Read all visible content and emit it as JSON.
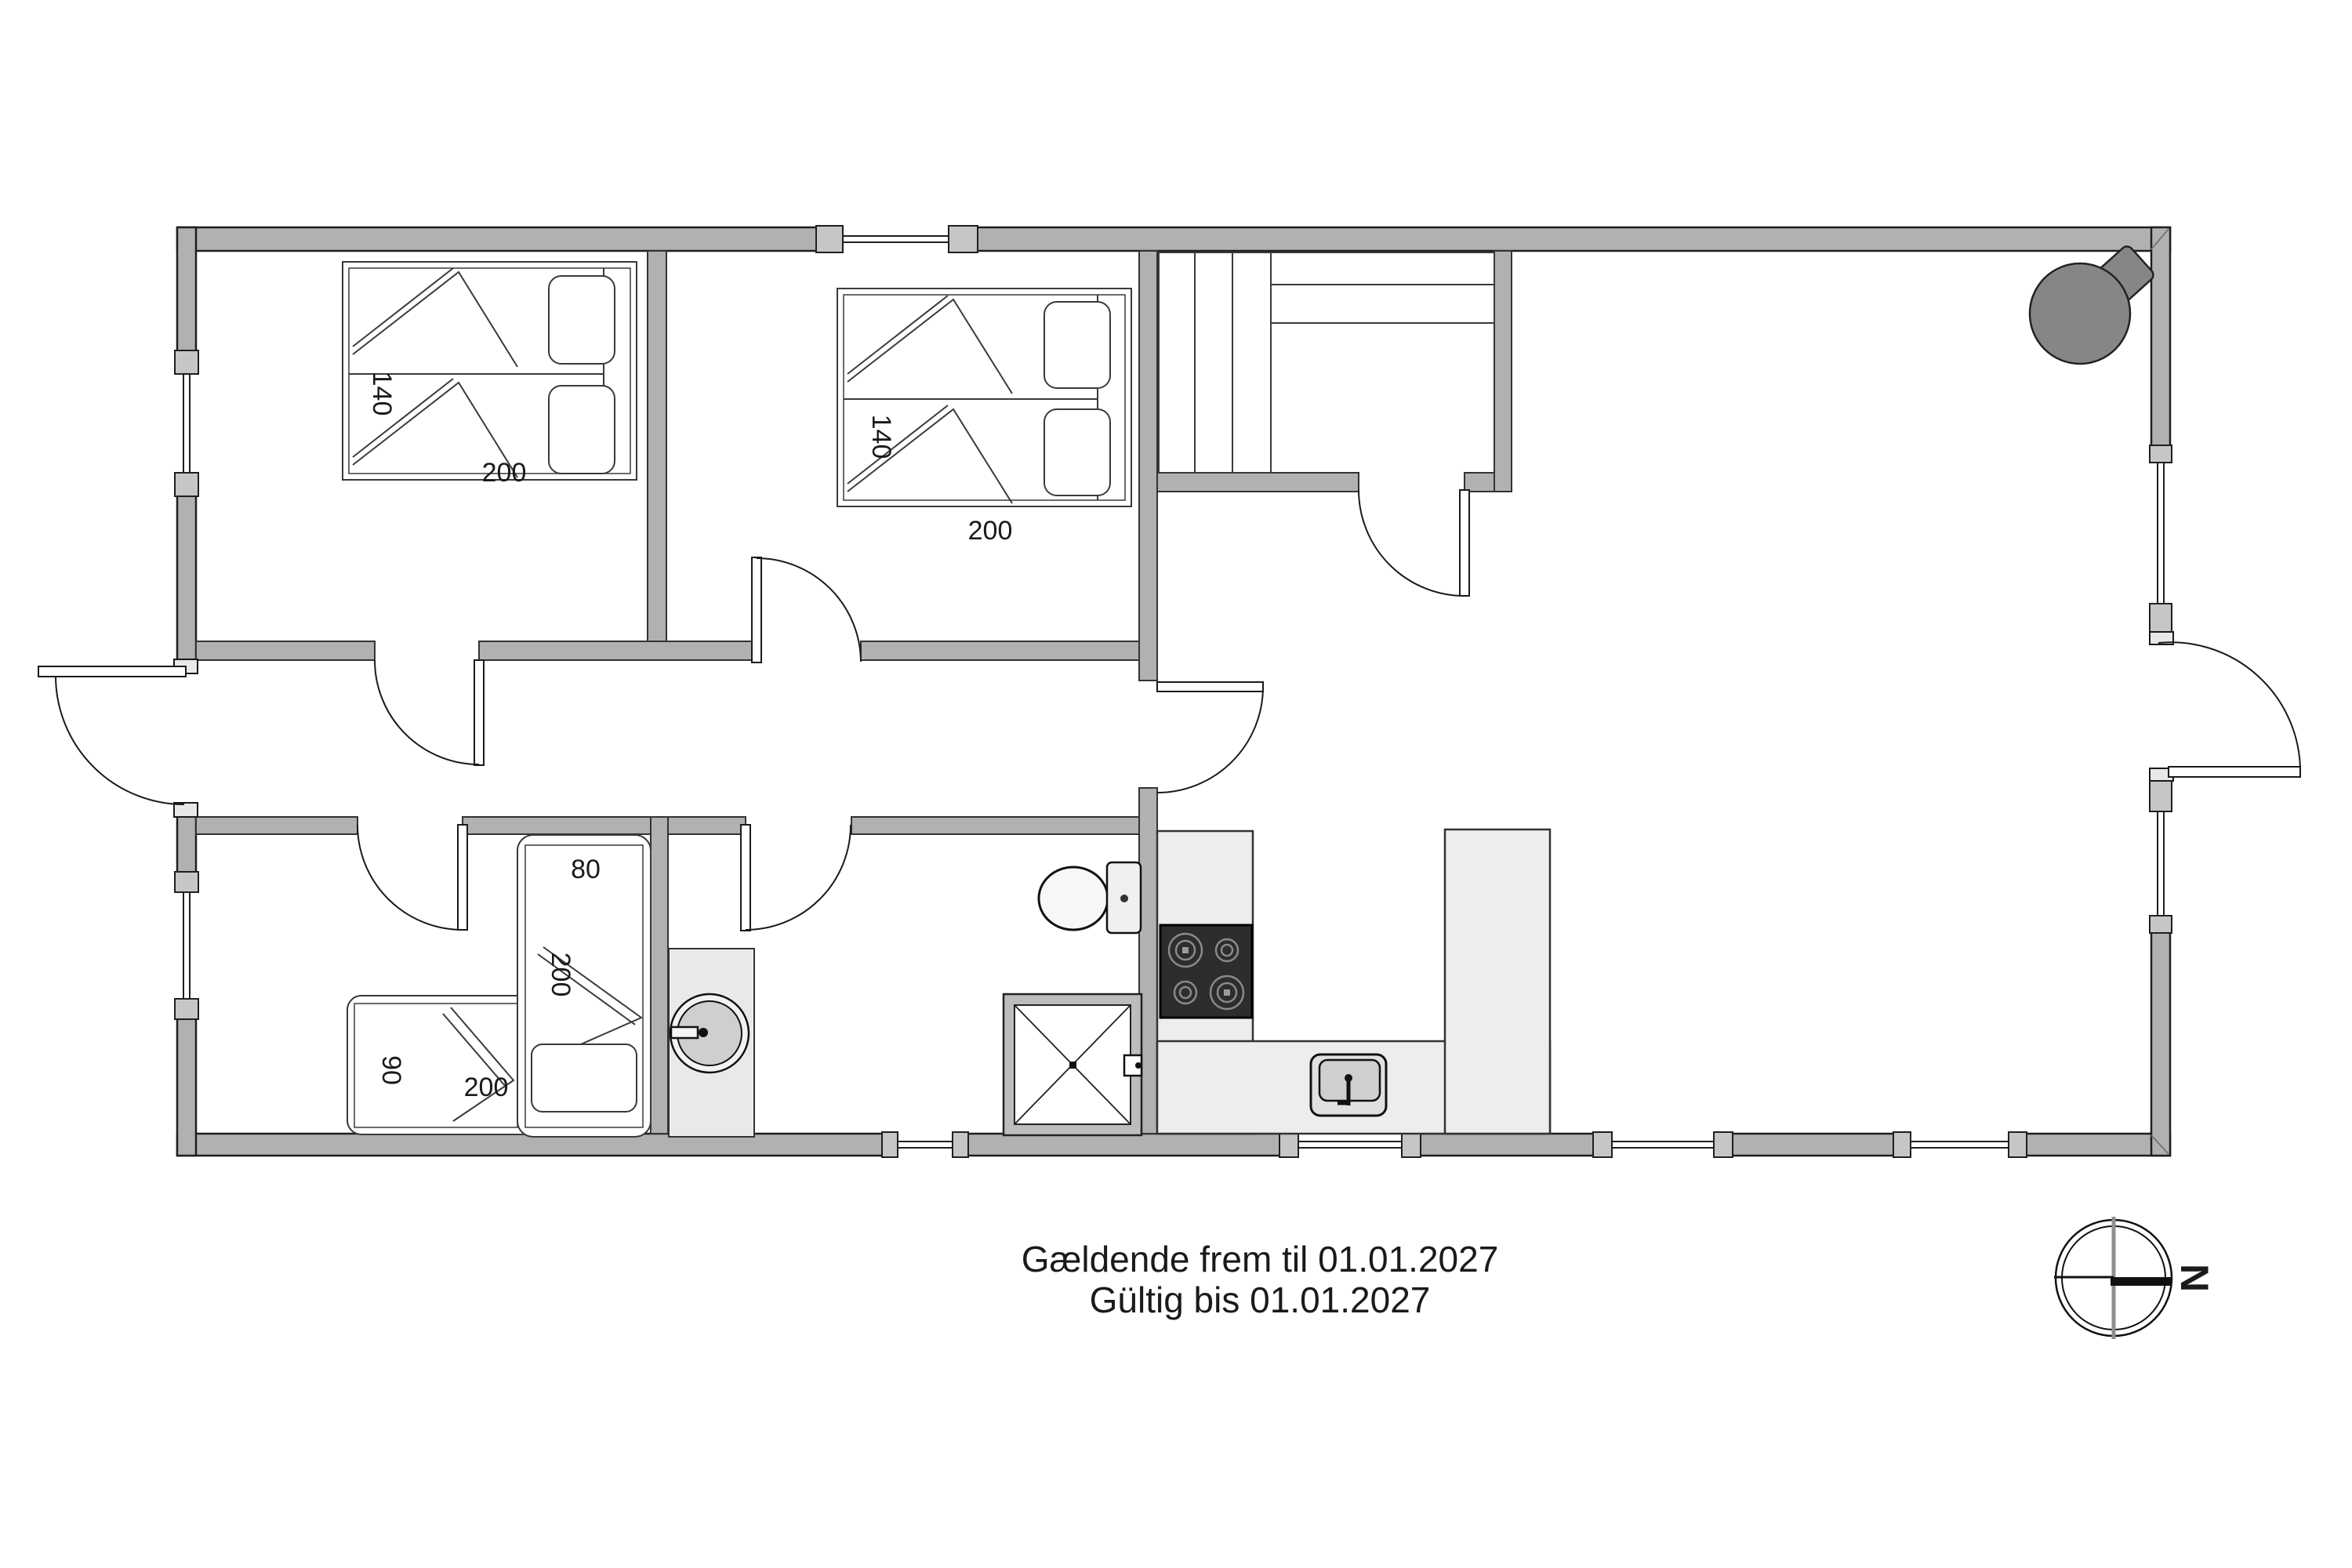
{
  "footer": {
    "line1": "Gældende frem til 01.01.2027",
    "line2": "Gültig bis 01.01.2027"
  },
  "compass": {
    "north_label": "N"
  },
  "labels": {
    "bedroom1_bed_width": "140",
    "bedroom1_bed_length": "200",
    "bedroom2_bed_width": "140",
    "bedroom2_bed_length": "200",
    "kids_bed_right_width": "80",
    "kids_bed_right_length": "200",
    "kids_bed_left_width": "90",
    "kids_bed_left_length": "200"
  },
  "colors": {
    "background": "#ffffff",
    "wall": "#b1b1b1",
    "wall_stroke": "#1f1f1f",
    "counter": "#ededed",
    "cooktop": "#2d2d2d",
    "stove": "#868686",
    "fixture_fill": "#f2f2f2",
    "basin_fill": "#cfcfcf",
    "text": "#1a1a1a"
  }
}
